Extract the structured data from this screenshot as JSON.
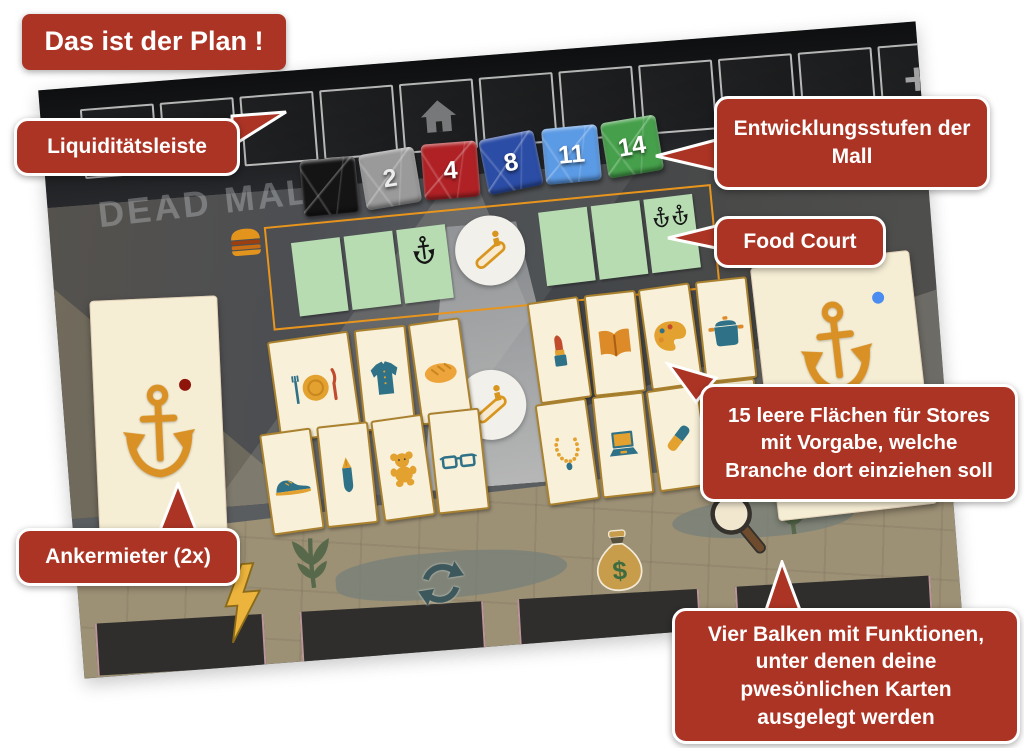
{
  "annotations": {
    "title": "Das ist der Plan !",
    "liquidity_label": "Liquiditätsleiste",
    "development_label": "Entwicklungsstufen der Mall",
    "food_court_label": "Food Court",
    "stores_label": "15 leere Flächen für Stores mit Vorgabe, welche Branche dort einziehen soll",
    "anchor_label": "Ankermieter (2x)",
    "bars_label": "Vier Balken mit Funktionen, unter denen deine pwesönlichen Karten ausgelegt werden"
  },
  "board": {
    "watermark": "DEAD MALL",
    "liquidity_track": {
      "cell_count": 11,
      "home_cell": 5,
      "plus_label": "+"
    },
    "development_tiles": [
      {
        "label": "",
        "color": "#141414"
      },
      {
        "label": "2",
        "color": "#9a9a9a"
      },
      {
        "label": "4",
        "color": "#b02125"
      },
      {
        "label": "8",
        "color": "#2b4da6"
      },
      {
        "label": "11",
        "color": "#5b9ae4"
      },
      {
        "label": "14",
        "color": "#46a04b"
      }
    ],
    "food_court": {
      "cell_count": 6,
      "single_anchor_cell": 3,
      "double_anchor_cell": 6
    },
    "store_tiles": [
      "restaurant",
      "fashion",
      "bakery",
      "cosmetics",
      "books",
      "art",
      "cookware",
      "shoes",
      "stationery",
      "toys",
      "optician",
      "jewelry",
      "electronics",
      "pharmacy",
      "sports"
    ],
    "anchor_cards": [
      {
        "position": "left",
        "dot_color": "#8e150c"
      },
      {
        "position": "right",
        "dot_color": "#4a8cf0"
      }
    ],
    "function_bars": [
      "lightning",
      "recycle",
      "money-bag",
      "magnifier"
    ]
  },
  "colors": {
    "annotation_red": "#ac3425",
    "food_court_green": "#b7dcb2",
    "tile_cream": "#f8f0d8",
    "tile_border": "#a9812f",
    "outline_orange": "#e8951d"
  }
}
